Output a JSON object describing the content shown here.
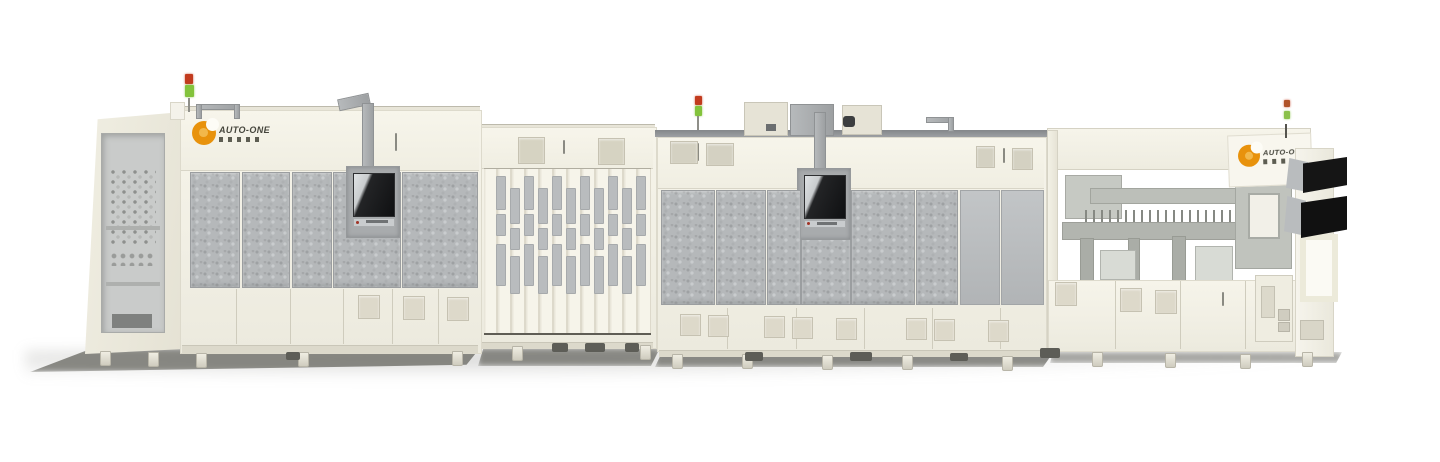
{
  "scene": {
    "type": "product-render",
    "subject": "Automated production line machine on white background",
    "background_color": "#ffffff"
  },
  "branding": {
    "name": "AUTO-ONE",
    "left_logo_text": "AUTO-ONE",
    "right_logo_text": "AUTO-ONE",
    "swirl_color": "#e8920c"
  },
  "colors": {
    "cabinet_body": "#f2f0e5",
    "cabinet_trim": "#dcd9cb",
    "mesh_panel": "#b5b8ba",
    "plain_panel": "#bcbfc1",
    "monitor_plate": "#a8abad",
    "screen_black": "#161718",
    "screen_reflection": "#d7dadc",
    "roof_rail": "#8f9294",
    "ground_shadow": "#6e6e68",
    "signal_red": "#c23b1e",
    "signal_green": "#83c33c",
    "accent_orange": "#e8920c"
  },
  "machine": {
    "sections": [
      {
        "name": "left-enclosure"
      },
      {
        "name": "folding-door-module"
      },
      {
        "name": "center-enclosure"
      },
      {
        "name": "open-frame-module"
      }
    ],
    "signal_towers": 3,
    "hmi_monitors": 2,
    "side_mounted_screens": 2
  }
}
